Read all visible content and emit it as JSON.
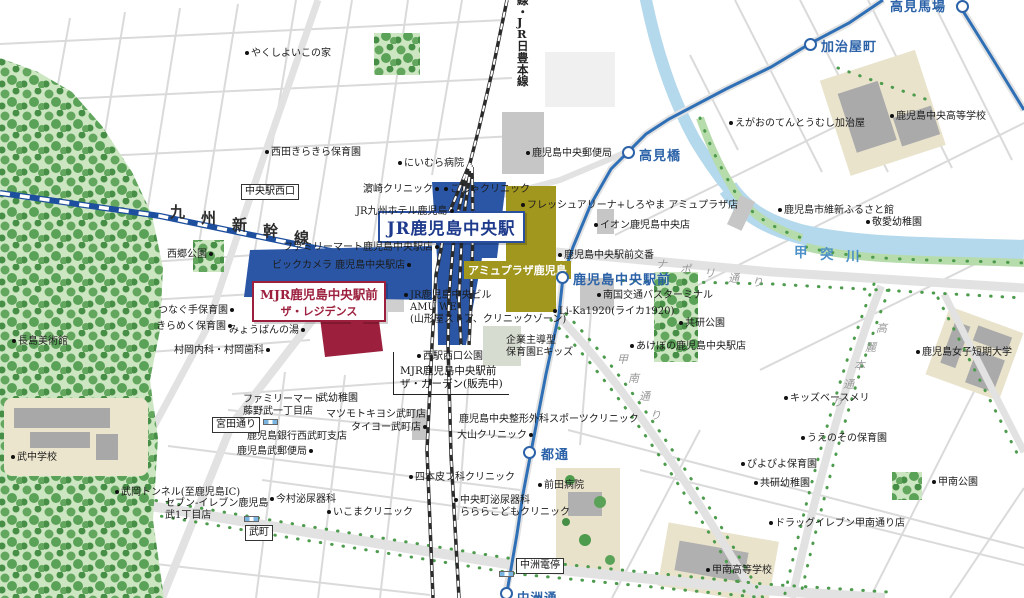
{
  "colors": {
    "station_blue": "#2a56a5",
    "amu_olive": "#a1961e",
    "mjr_crimson": "#9c1f3d",
    "tram_blue": "#2f6fb5",
    "river_blue": "#b4d8ec",
    "forest_green": "#cde6c2",
    "tree_green": "#4d9b4d",
    "road_gray": "#e2e2e2"
  },
  "callouts": {
    "station": "JR鹿児島中央駅",
    "amu": "アミュプラザ鹿児島",
    "mjr_line1": "MJR鹿児島中央駅前",
    "mjr_line2": "ザ・レジデンス",
    "garden": "MJR鹿児島中央駅前\nザ・ガーデン(販売中)"
  },
  "spread_labels": [
    {
      "text": "九州新幹線",
      "x": 170,
      "y": 201,
      "dx": 31,
      "dy": 6.4,
      "cls": "rail"
    },
    {
      "text": "線・JR日豊本線",
      "x": 517,
      "y": -8,
      "dx": 0,
      "dy": 11.6,
      "cls": "railv"
    },
    {
      "text": "甲突川",
      "x": 794,
      "y": 241,
      "dx": 26,
      "dy": 2,
      "cls": "river"
    },
    {
      "text": "ナポリ通り",
      "x": 656,
      "y": 256,
      "dx": 24,
      "dy": 4.5,
      "cls": "st"
    },
    {
      "text": "甲南通り",
      "x": 617,
      "y": 351,
      "dx": 11,
      "dy": 18.5,
      "cls": "st"
    },
    {
      "text": "高麗本通り",
      "x": 876,
      "y": 320,
      "dx": -11,
      "dy": 18.5,
      "cls": "st"
    }
  ],
  "tram_stops": [
    {
      "name": "鹿児島中央駅前",
      "cx": 562,
      "cy": 277,
      "tx": 573,
      "ty": 269,
      "fs": 13
    },
    {
      "name": "高見橋",
      "cx": 628,
      "cy": 152,
      "tx": 639,
      "ty": 145,
      "fs": 13
    },
    {
      "name": "加治屋町",
      "cx": 810,
      "cy": 44,
      "tx": 821,
      "ty": 36,
      "fs": 13
    },
    {
      "name": "高見馬場",
      "cx": 962,
      "cy": 6,
      "tx": 890,
      "ty": -4,
      "fs": 13
    },
    {
      "name": "都通",
      "cx": 529,
      "cy": 452,
      "tx": 541,
      "ty": 444,
      "fs": 13
    },
    {
      "name": "中洲通",
      "cx": 506,
      "cy": 593,
      "tx": 517,
      "ty": 587,
      "fs": 12.5
    }
  ],
  "intersections": [
    {
      "name": "中央駅西口",
      "x": 241,
      "y": 184
    },
    {
      "name": "宮田通り",
      "x": 212,
      "y": 417
    },
    {
      "name": "武町",
      "x": 245,
      "y": 525
    },
    {
      "name": "中洲電停",
      "x": 516,
      "y": 558
    }
  ],
  "signals": [
    {
      "x": 263,
      "y": 419
    },
    {
      "x": 244,
      "y": 516
    },
    {
      "x": 499,
      "y": 571
    }
  ],
  "pois": [
    {
      "t": "やくしよいこの家",
      "x": 243,
      "y": 48,
      "dot": "l"
    },
    {
      "t": "西田きらきら保育園",
      "x": 263,
      "y": 147,
      "dot": "l"
    },
    {
      "t": "にいむら病院",
      "x": 396,
      "y": 158,
      "dot": "l"
    },
    {
      "t": "濵崎クリニック",
      "x": 363,
      "y": 184,
      "dot": "r"
    },
    {
      "t": "こしゃクリニック",
      "x": 442,
      "y": 184,
      "dot": "l"
    },
    {
      "t": "JR九州ホテル鹿児島",
      "x": 356,
      "y": 206,
      "dot": "r"
    },
    {
      "t": "ファミリーマート鹿児島中央駅店",
      "x": 283,
      "y": 242,
      "dot": "r"
    },
    {
      "t": "ビックカメラ 鹿児島中央駅店",
      "x": 272,
      "y": 260,
      "dot": "r"
    },
    {
      "t": "フレッシュアリーナ+しろやま アミュプラザ店",
      "x": 519,
      "y": 200,
      "dot": "l"
    },
    {
      "t": "イオン鹿児島中央店",
      "x": 592,
      "y": 220,
      "dot": "l"
    },
    {
      "t": "鹿児島中央駅前交番",
      "x": 556,
      "y": 250,
      "dot": "l"
    },
    {
      "t": "南国交通バスターミナル",
      "x": 595,
      "y": 290,
      "dot": "l"
    },
    {
      "t": "Li-Ka1920(ライカ1920)",
      "x": 551,
      "y": 306,
      "dot": "l"
    },
    {
      "t": "JR鹿児島中央ビル\nAMU WE\n(山形屋ストア、クリニックゾーン)",
      "x": 402,
      "y": 290,
      "dot": "l"
    },
    {
      "t": "西駅西口公園",
      "x": 415,
      "y": 351,
      "dot": "l"
    },
    {
      "t": "企業主導型\n保育園Eキッズ",
      "x": 506,
      "y": 335,
      "dot": "n"
    },
    {
      "t": "あけぼの鹿児島中央駅店",
      "x": 628,
      "y": 341,
      "dot": "l"
    },
    {
      "t": "共研公園",
      "x": 677,
      "y": 318,
      "dot": "l"
    },
    {
      "t": "鹿児島市維新ふるさと館",
      "x": 776,
      "y": 205,
      "dot": "l"
    },
    {
      "t": "敬愛幼稚園",
      "x": 864,
      "y": 217,
      "dot": "l"
    },
    {
      "t": "えがおのてんとうむし加治屋",
      "x": 727,
      "y": 118,
      "dot": "l"
    },
    {
      "t": "鹿児島中央高等学校",
      "x": 888,
      "y": 111,
      "dot": "l"
    },
    {
      "t": "鹿児島中央郵便局",
      "x": 524,
      "y": 148,
      "dot": "l"
    },
    {
      "t": "鹿児島女子短期大学",
      "x": 914,
      "y": 347,
      "dot": "l"
    },
    {
      "t": "キッズベースメリ",
      "x": 782,
      "y": 393,
      "dot": "l"
    },
    {
      "t": "うえのその保育園",
      "x": 799,
      "y": 433,
      "dot": "l"
    },
    {
      "t": "ぴよぴよ保育園",
      "x": 739,
      "y": 459,
      "dot": "l"
    },
    {
      "t": "共研幼稚園",
      "x": 752,
      "y": 478,
      "dot": "l"
    },
    {
      "t": "ドラッグイレブン甲南通り店",
      "x": 767,
      "y": 518,
      "dot": "l"
    },
    {
      "t": "甲南公園",
      "x": 930,
      "y": 477,
      "dot": "l"
    },
    {
      "t": "甲南高等学校",
      "x": 704,
      "y": 565,
      "dot": "l"
    },
    {
      "t": "武中学校",
      "x": 9,
      "y": 452,
      "dot": "l"
    },
    {
      "t": "長島美術館",
      "x": 10,
      "y": 336,
      "dot": "l"
    },
    {
      "t": "西郷公園",
      "x": 167,
      "y": 249,
      "dot": "r"
    },
    {
      "t": "つなぐ手保育園",
      "x": 158,
      "y": 305,
      "dot": "r"
    },
    {
      "t": "きらめく保育園",
      "x": 156,
      "y": 321,
      "dot": "r"
    },
    {
      "t": "みょうばんの湯",
      "x": 229,
      "y": 325,
      "dot": "r"
    },
    {
      "t": "村岡内科・村岡歯科",
      "x": 174,
      "y": 345,
      "dot": "r"
    },
    {
      "t": "ファミリーマート\n藤野武一丁目店",
      "x": 243,
      "y": 394,
      "dot": "n"
    },
    {
      "t": "武幼稚園",
      "x": 318,
      "y": 393,
      "dot": "n"
    },
    {
      "t": "マツモトキヨシ武町店",
      "x": 326,
      "y": 409,
      "dot": "n"
    },
    {
      "t": "タイヨー武町店",
      "x": 351,
      "y": 422,
      "dot": "r"
    },
    {
      "t": "鹿児島銀行西武町支店",
      "x": 247,
      "y": 431,
      "dot": "n"
    },
    {
      "t": "鹿児島武郵便局",
      "x": 237,
      "y": 446,
      "dot": "r"
    },
    {
      "t": "今村泌尿器科",
      "x": 268,
      "y": 494,
      "dot": "l"
    },
    {
      "t": "セブン-イレブン鹿児島\n武1丁目店",
      "x": 165,
      "y": 498,
      "dot": "n"
    },
    {
      "t": "武岡トンネル(至鹿児島IC)",
      "x": 113,
      "y": 487,
      "dot": "l"
    },
    {
      "t": "いこまクリニック",
      "x": 325,
      "y": 507,
      "dot": "l"
    },
    {
      "t": "四本皮フ科クリニック",
      "x": 407,
      "y": 472,
      "dot": "l"
    },
    {
      "t": "中央町泌尿器科\nらららこどもクリニック",
      "x": 452,
      "y": 495,
      "dot": "l"
    },
    {
      "t": "大山クリニック",
      "x": 457,
      "y": 430,
      "dot": "r"
    },
    {
      "t": "鹿児島中央整形外科スポーツクリニック",
      "x": 459,
      "y": 414,
      "dot": "n"
    },
    {
      "t": "前田病院",
      "x": 536,
      "y": 480,
      "dot": "l"
    }
  ]
}
